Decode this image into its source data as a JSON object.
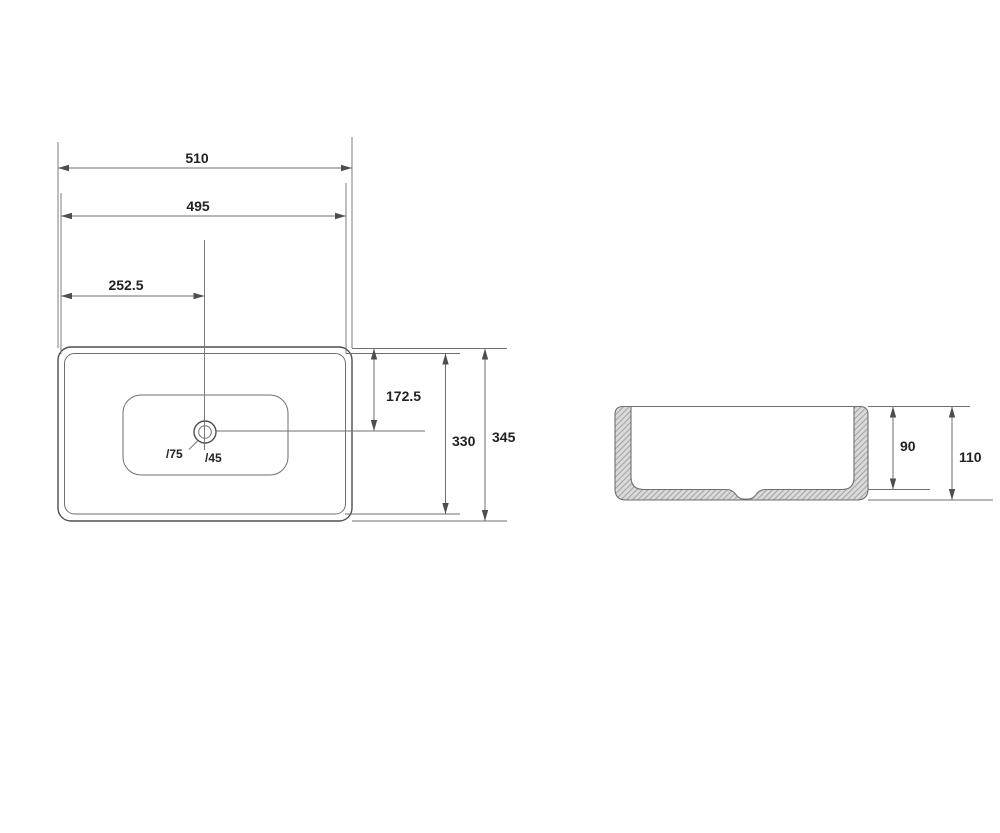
{
  "colors": {
    "background": "#ffffff",
    "line": "#6f6f6f",
    "line-strong": "#4e4e4e",
    "text": "#222222",
    "hatch-fill": "#dadada",
    "hatch-line": "#a3a3a3"
  },
  "plan_view": {
    "overall_width": "510",
    "rim_width": "495",
    "drain_offset": "252.5",
    "center_depth": "172.5",
    "rim_depth": "330",
    "overall_depth": "345",
    "overflow_label": "/75",
    "waste_label": "/45"
  },
  "section_view": {
    "inner_depth": "90",
    "overall_height": "110"
  }
}
